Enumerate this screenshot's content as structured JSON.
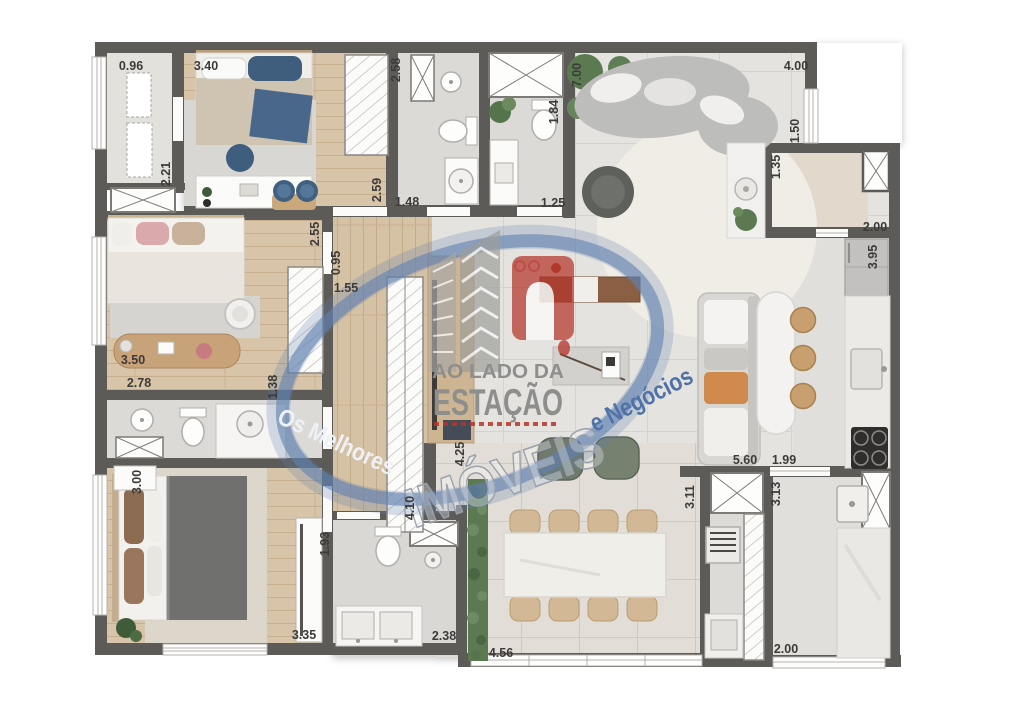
{
  "plan": {
    "kind": "apartment-floor-plan",
    "units": "meters"
  },
  "dims": [
    "0.96",
    "3.40",
    "2.58",
    "2.21",
    "2.59",
    "1.48",
    "1.84",
    "1.25",
    "7.00",
    "4.00",
    "1.50",
    "1.35",
    "2.00",
    "3.95",
    "2.55",
    "0.95",
    "1.55",
    "3.50",
    "2.78",
    "1.38",
    "4.25",
    "4.10",
    "3.00",
    "1.93",
    "3.35",
    "2.38",
    "4.56",
    "3.11",
    "5.60",
    "1.99",
    "3.13",
    "2.00"
  ],
  "watermark": {
    "brand_line1": "AO LADO DA",
    "brand_line2": "ESTAÇÃO",
    "arc_left": "Os Melhores",
    "arc_center": "IMÓVEIS",
    "arc_right": "e Negócios"
  },
  "colors": {
    "wall": "#5d5b58",
    "swoosh_blue": "#6080b0",
    "logo_red": "#b5352c",
    "logo_gray": "#9c9c9a"
  }
}
